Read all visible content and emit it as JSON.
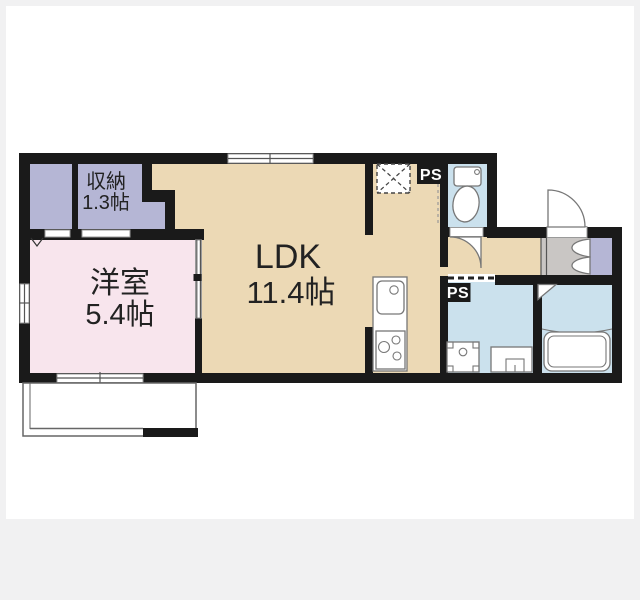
{
  "colors": {
    "bg": "#f1f1f2",
    "paper": "#ffffff",
    "wall": "#1a1a1a",
    "beige": "#ecd9b5",
    "pink": "#f8e5ed",
    "lavender": "#b5b6d5",
    "blue": "#cbe1ed",
    "gray": "#c9c6c4",
    "outline": "#777777"
  },
  "rooms": {
    "ldk": {
      "name": "LDK",
      "size": "11.4帖"
    },
    "western": {
      "name": "洋室",
      "size": "5.4帖"
    },
    "storage": {
      "name": "収納",
      "size": "1.3帖"
    }
  },
  "labels": {
    "ps_upper": "PS",
    "ps_lower": "PS"
  }
}
